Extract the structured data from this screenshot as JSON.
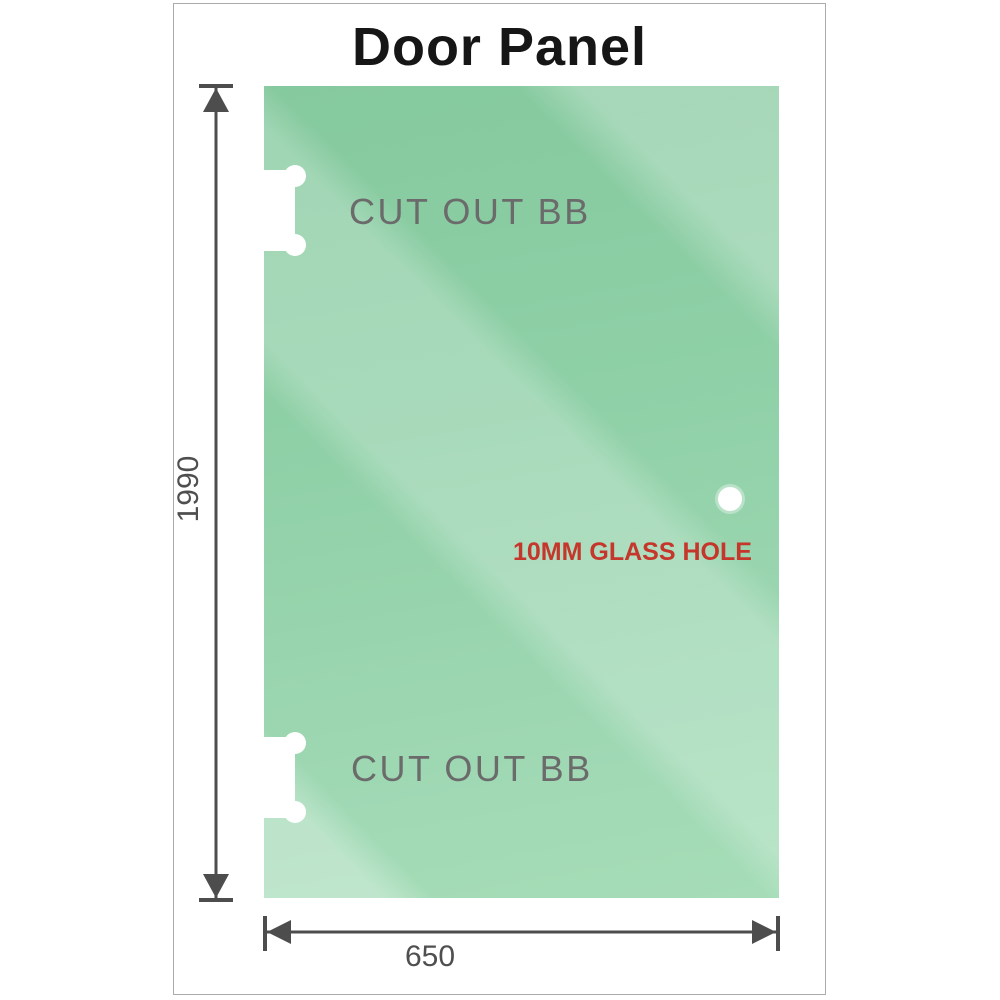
{
  "title": "Door Panel",
  "panel": {
    "glass_base_color": "#8fd0a7",
    "glass_highlight_color": "#b7e4c8"
  },
  "cutouts": {
    "top": {
      "label": "CUT OUT BB"
    },
    "bottom": {
      "label": "CUT OUT BB"
    }
  },
  "glass_hole": {
    "label": "10MM GLASS HOLE",
    "label_color": "#c5362b"
  },
  "dimensions": {
    "height": {
      "value": "1990"
    },
    "width": {
      "value": "650"
    }
  },
  "colors": {
    "dimension_line": "#4d4d4d",
    "label_gray": "#6b6b6b",
    "frame_border": "#ababab"
  }
}
